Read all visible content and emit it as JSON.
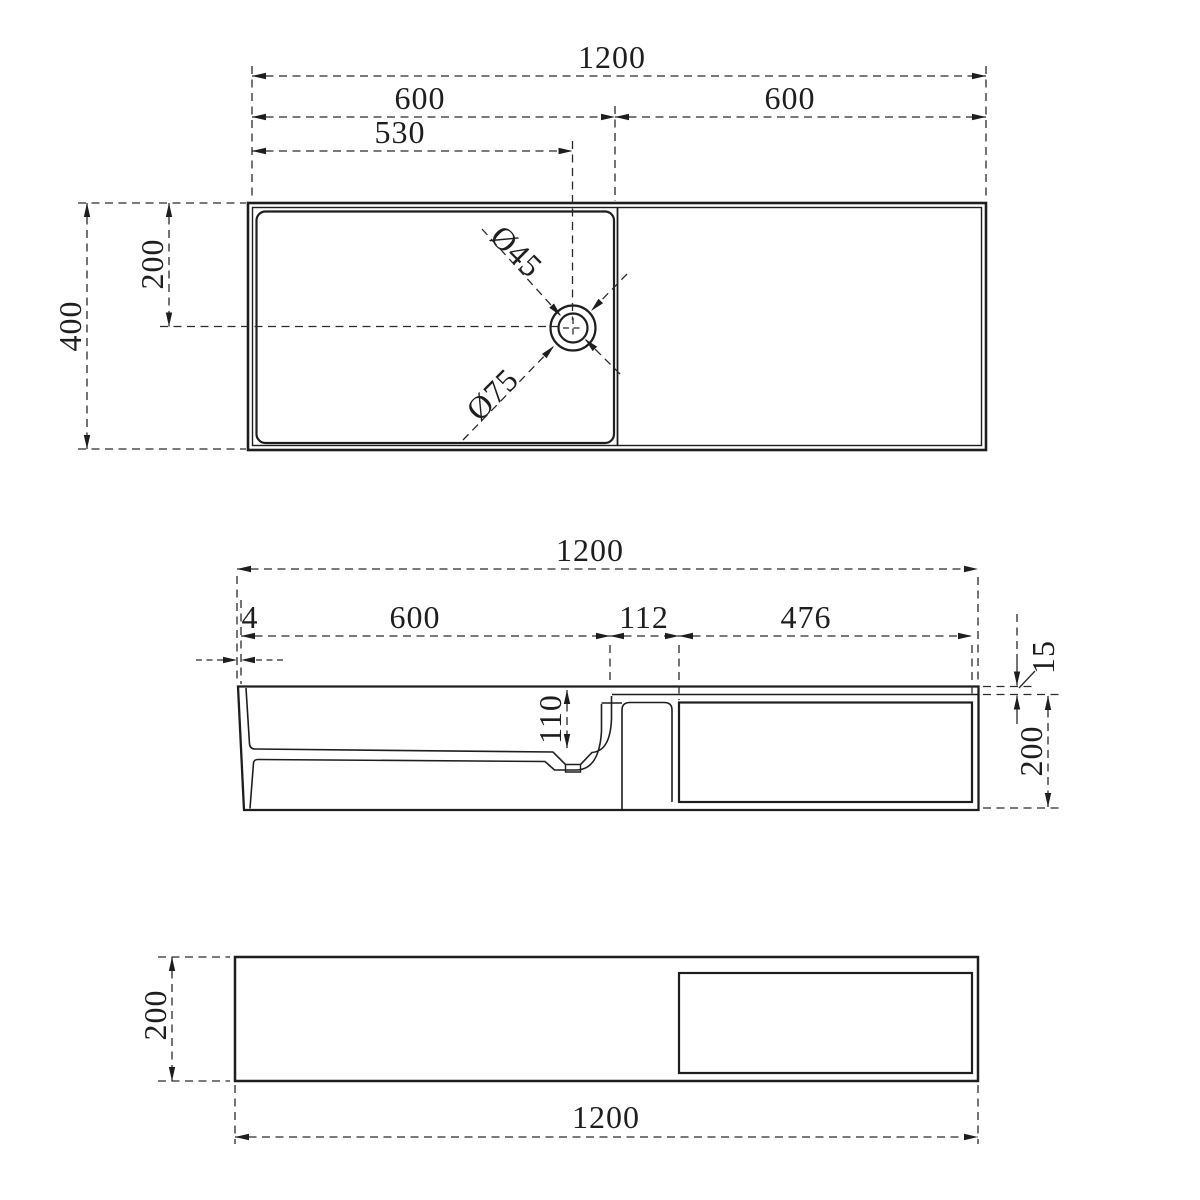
{
  "views": {
    "top": {
      "title": "top view",
      "dims": {
        "overall_width": "1200",
        "left_section_width": "600",
        "right_section_width": "600",
        "drain_center_from_left": "530",
        "overall_depth": "400",
        "drain_center_offset": "200",
        "drain_hole_diameter": "Ø45",
        "drain_flange_diameter": "Ø75"
      }
    },
    "front": {
      "title": "front section view",
      "dims": {
        "overall_width": "1200",
        "left_rim_thickness": "4",
        "basin_inner_width": "600",
        "deck_width": "112",
        "recess_width": "476",
        "basin_inner_depth": "110",
        "top_edge_thickness": "15",
        "overall_height": "200"
      }
    },
    "bottom": {
      "title": "bottom view",
      "dims": {
        "overall_height": "200",
        "overall_width": "1200"
      }
    }
  },
  "colors": {
    "line": "#1e1e1e",
    "background": "#ffffff"
  }
}
